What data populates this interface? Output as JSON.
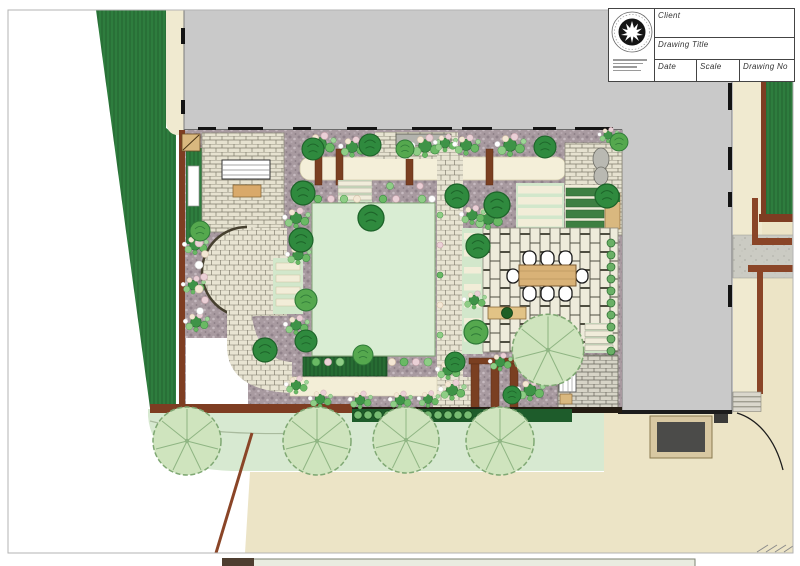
{
  "document": {
    "type": "garden-landscape-design-plan",
    "orientation": "top-down plan view"
  },
  "title_block": {
    "client_label": "Client",
    "client_value": "",
    "drawing_title_label": "Drawing Title",
    "drawing_title_value": "",
    "date_label": "Date",
    "date_value": "",
    "scale_label": "Scale",
    "scale_value": "",
    "drawing_no_label": "Drawing No",
    "drawing_no_value": ""
  },
  "logo": {
    "icon": "circular-stamp-with-white-maple-leaf-star",
    "ring_text_legible": false
  },
  "palette": {
    "building_gray": "#c9c9c9",
    "hedge_green": "#2e7d3e",
    "lawn_green": "#d9edd3",
    "verge_green": "#d7e9d1",
    "road_beige": "#ece4c6",
    "walkway_cream": "#f4efd9",
    "brick_cream": "#e6e2d0",
    "planting_bed_mauve": "#a89aa0",
    "wall_brown": "#7e3d22",
    "timber_tan": "#d9b87f",
    "foliage_dark": "#2f8a3e",
    "foliage_light": "#8ecd86",
    "flower_pink": "#ead0d6",
    "pale_tree_green": "#cfe4be",
    "ink": "#1a1a1a"
  }
}
